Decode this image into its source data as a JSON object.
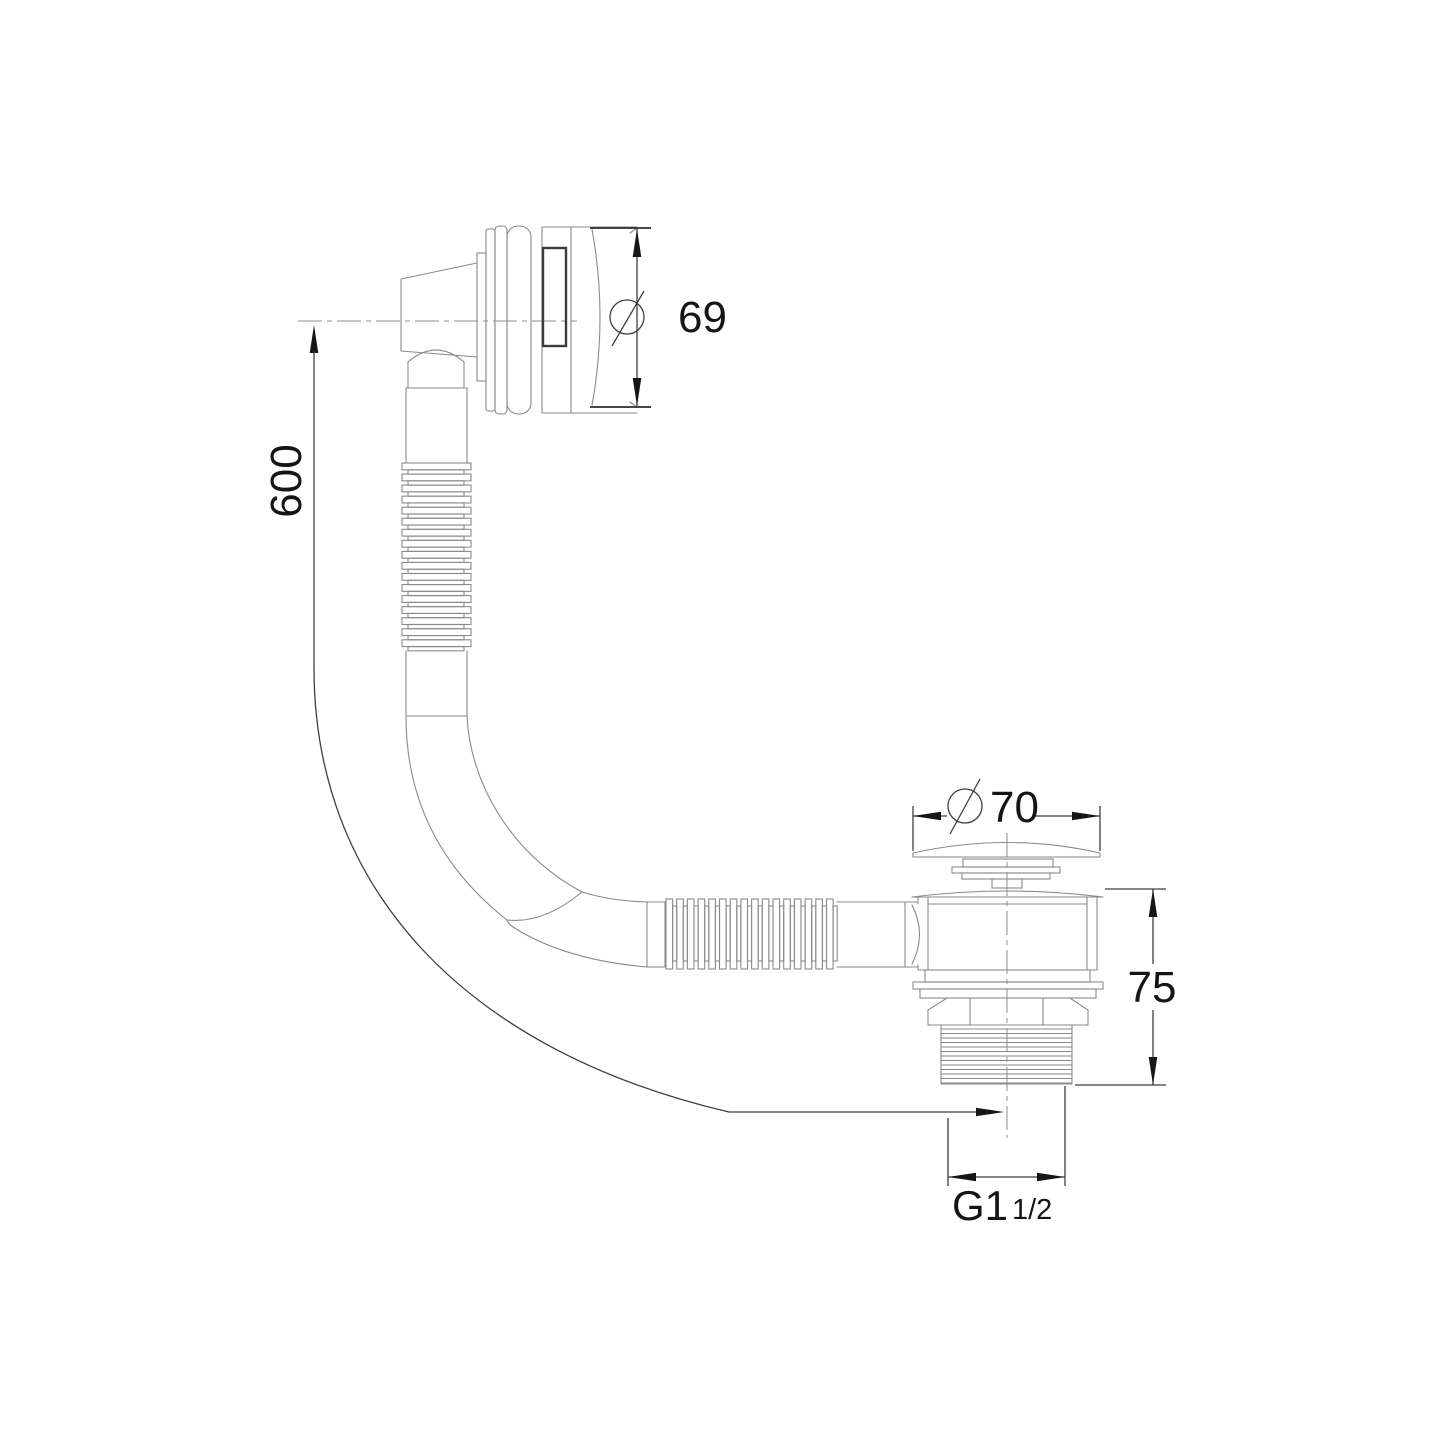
{
  "drawing": {
    "kind": "technical-dimension-drawing",
    "subject": "bath-overflow-and-waste-with-flexible-hose",
    "background": "#ffffff",
    "colors": {
      "outline": "#8a8a8a",
      "dimension_lines": "#3f3f3f",
      "dimension_text": "#151515",
      "accent": "#3c3c3c"
    }
  },
  "labels": {
    "overflow_diameter": {
      "symbol": "diameter-symbol",
      "value": "69"
    },
    "hose_length": {
      "value": "600"
    },
    "waste_cap_diameter": {
      "symbol": "diameter-symbol",
      "value": "70"
    },
    "waste_height": {
      "value": "75"
    },
    "thread_size": {
      "main": "G1",
      "fraction": "1/2"
    }
  }
}
